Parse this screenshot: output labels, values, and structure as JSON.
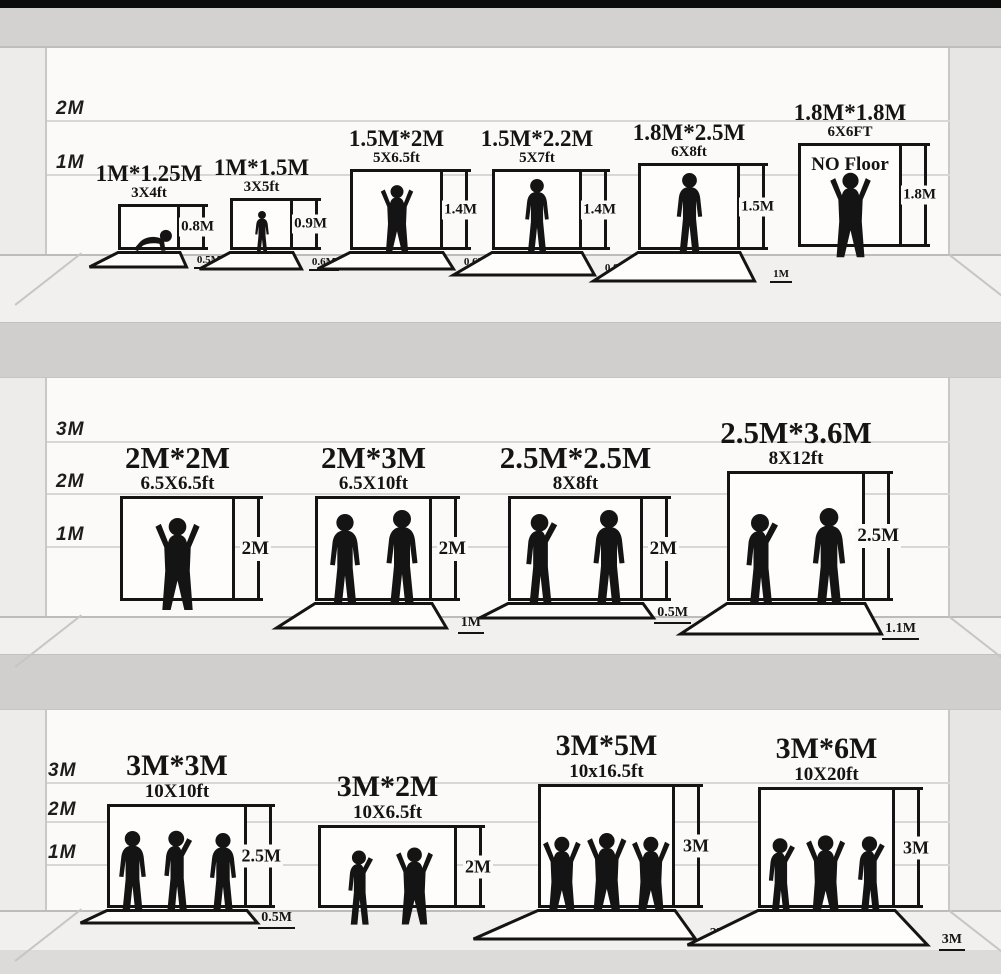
{
  "meta": {
    "description": "Photography backdrop size comparison chart",
    "ink_color": "#141414"
  },
  "rows": [
    {
      "scale_labels": [
        "2M",
        "1M"
      ],
      "backdrops": [
        {
          "title": "1M*1.25M",
          "subtitle": "3X4ft",
          "height_label": "0.8M",
          "floor_label": "0.5M",
          "figures": [
            {
              "pose": "crawl",
              "h": 24
            }
          ]
        },
        {
          "title": "1M*1.5M",
          "subtitle": "3X5ft",
          "height_label": "0.9M",
          "floor_label": "0.6M",
          "figures": [
            {
              "pose": "stand",
              "h": 44
            }
          ]
        },
        {
          "title": "1.5M*2M",
          "subtitle": "5X6.5ft",
          "height_label": "1.4M",
          "floor_label": "0.6M",
          "figures": [
            {
              "pose": "up",
              "h": 72
            }
          ]
        },
        {
          "title": "1.5M*2.2M",
          "subtitle": "5X7ft",
          "height_label": "1.4M",
          "floor_label": "0.8M",
          "figures": [
            {
              "pose": "stand",
              "h": 76
            }
          ]
        },
        {
          "title": "1.8M*2.5M",
          "subtitle": "6X8ft",
          "height_label": "1.5M",
          "floor_label": "1M",
          "figures": [
            {
              "pose": "stand",
              "h": 82
            }
          ]
        },
        {
          "title": "1.8M*1.8M",
          "subtitle": "6X6FT",
          "height_label": "1.8M",
          "note": "NO Floor",
          "figures": [
            {
              "pose": "up",
              "h": 90
            }
          ]
        }
      ]
    },
    {
      "scale_labels": [
        "3M",
        "2M",
        "1M"
      ],
      "backdrops": [
        {
          "title": "2M*2M",
          "subtitle": "6.5X6.5ft",
          "height_label": "2M",
          "figures": [
            {
              "pose": "up",
              "h": 98
            }
          ]
        },
        {
          "title": "2M*3M",
          "subtitle": "6.5X10ft",
          "height_label": "2M",
          "floor_label": "1M",
          "figures": [
            {
              "pose": "stand",
              "h": 96
            },
            {
              "pose": "stand",
              "h": 100
            }
          ]
        },
        {
          "title": "2.5M*2.5M",
          "subtitle": "8X8ft",
          "height_label": "2M",
          "floor_label": "0.5M",
          "figures": [
            {
              "pose": "wave",
              "h": 98
            },
            {
              "pose": "stand",
              "h": 100
            }
          ]
        },
        {
          "title": "2.5M*3.6M",
          "subtitle": "8X12ft",
          "height_label": "2.5M",
          "floor_label": "1.1M",
          "figures": [
            {
              "pose": "wave",
              "h": 100
            },
            {
              "pose": "stand",
              "h": 104
            }
          ]
        }
      ]
    },
    {
      "scale_labels": [
        "3M",
        "2M",
        "1M"
      ],
      "backdrops": [
        {
          "title": "3M*3M",
          "subtitle": "10X10ft",
          "height_label": "2.5M",
          "floor_label": "0.5M",
          "figures": [
            {
              "pose": "stand",
              "h": 86
            },
            {
              "pose": "wave",
              "h": 88
            },
            {
              "pose": "stand",
              "h": 84
            }
          ]
        },
        {
          "title": "3M*2M",
          "subtitle": "10X6.5ft",
          "height_label": "2M",
          "figures": [
            {
              "pose": "wave",
              "h": 78
            },
            {
              "pose": "up",
              "h": 82
            }
          ]
        },
        {
          "title": "3M*5M",
          "subtitle": "10x16.5ft",
          "height_label": "3M",
          "floor_label": "2M",
          "figures": [
            {
              "pose": "up",
              "h": 90
            },
            {
              "pose": "up",
              "h": 94
            },
            {
              "pose": "up",
              "h": 90
            }
          ]
        },
        {
          "title": "3M*6M",
          "subtitle": "10X20ft",
          "height_label": "3M",
          "floor_label": "3M",
          "figures": [
            {
              "pose": "wave",
              "h": 90
            },
            {
              "pose": "up",
              "h": 94
            },
            {
              "pose": "wave",
              "h": 92
            }
          ]
        }
      ]
    }
  ]
}
